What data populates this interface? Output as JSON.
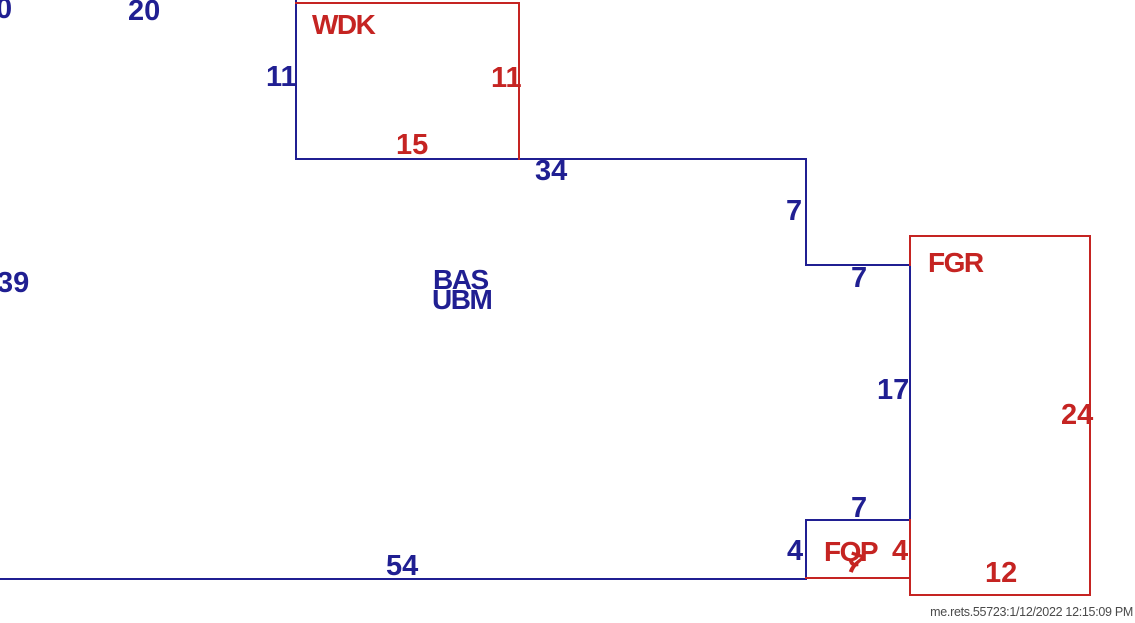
{
  "sketch": {
    "background": "#ffffff",
    "colors": {
      "blue": "#201f92",
      "red": "#c52422",
      "watermark": "#4a4a4a"
    },
    "watermark": "me.rets.55723:1/12/2022 12:15:09 PM",
    "area_codes": [
      "WDK",
      "BAS",
      "UBM",
      "FGR",
      "FQP"
    ],
    "labels": [
      {
        "name": "dim-top-left-0",
        "kind": "dimension",
        "text": "0",
        "color": "blue",
        "x": -4,
        "y": -6
      },
      {
        "name": "dim-top-20",
        "kind": "dimension",
        "text": "20",
        "color": "blue",
        "x": 128,
        "y": -4
      },
      {
        "name": "area-label-wdk",
        "kind": "area",
        "text": "WDK",
        "color": "red",
        "x": 312,
        "y": 10
      },
      {
        "name": "dim-wdk-left-11",
        "kind": "dimension",
        "text": "11",
        "color": "blue",
        "x": 266,
        "y": 62
      },
      {
        "name": "dim-wdk-right-11",
        "kind": "dimension",
        "text": "11",
        "color": "red",
        "x": 491,
        "y": 63
      },
      {
        "name": "dim-wdk-bottom-15",
        "kind": "dimension",
        "text": "15",
        "color": "red",
        "x": 396,
        "y": 130
      },
      {
        "name": "dim-main-top-34",
        "kind": "dimension",
        "text": "34",
        "color": "blue",
        "x": 535,
        "y": 156
      },
      {
        "name": "dim-step-down-7",
        "kind": "dimension",
        "text": "7",
        "color": "blue",
        "x": 786,
        "y": 196
      },
      {
        "name": "dim-step-right-7",
        "kind": "dimension",
        "text": "7",
        "color": "blue",
        "x": 851,
        "y": 263
      },
      {
        "name": "area-label-fgr",
        "kind": "area",
        "text": "FGR",
        "color": "red",
        "x": 928,
        "y": 248
      },
      {
        "name": "dim-left-39",
        "kind": "dimension",
        "text": "39",
        "color": "blue",
        "x": -3,
        "y": 268
      },
      {
        "name": "area-label-bas",
        "kind": "area",
        "text": "BAS",
        "color": "blue",
        "x": 433,
        "y": 265
      },
      {
        "name": "area-label-ubm",
        "kind": "area",
        "text": "UBM",
        "color": "blue",
        "x": 432,
        "y": 285
      },
      {
        "name": "dim-fgr-left-17",
        "kind": "dimension",
        "text": "17",
        "color": "blue",
        "x": 877,
        "y": 375
      },
      {
        "name": "dim-fgr-right-24",
        "kind": "dimension",
        "text": "24",
        "color": "red",
        "x": 1061,
        "y": 400
      },
      {
        "name": "dim-fqp-top-7",
        "kind": "dimension",
        "text": "7",
        "color": "blue",
        "x": 851,
        "y": 493
      },
      {
        "name": "dim-fqp-left-4",
        "kind": "dimension",
        "text": "4",
        "color": "blue",
        "x": 787,
        "y": 536
      },
      {
        "name": "area-label-fqp",
        "kind": "area",
        "text": "FQP",
        "color": "red",
        "x": 824,
        "y": 537
      },
      {
        "name": "dim-fqp-right-4",
        "kind": "dimension",
        "text": "4",
        "color": "red",
        "x": 892,
        "y": 536
      },
      {
        "name": "dim-fqp-bottom-7",
        "kind": "dimension",
        "text": "7",
        "color": "red",
        "x": 847,
        "y": 549,
        "rotate": 18
      },
      {
        "name": "dim-fgr-bottom-12",
        "kind": "dimension",
        "text": "12",
        "color": "red",
        "x": 985,
        "y": 558
      },
      {
        "name": "dim-main-bottom-54",
        "kind": "dimension",
        "text": "54",
        "color": "blue",
        "x": 386,
        "y": 551
      }
    ],
    "lines": [
      {
        "name": "wdk-left-wall",
        "color": "blue",
        "x": 295,
        "y": 0,
        "w": 2,
        "h": 160
      },
      {
        "name": "wdk-bottom-wall",
        "color": "blue",
        "x": 295,
        "y": 158,
        "w": 512,
        "h": 2
      },
      {
        "name": "step-down-wall",
        "color": "blue",
        "x": 805,
        "y": 158,
        "w": 2,
        "h": 108
      },
      {
        "name": "step-right-wall",
        "color": "blue",
        "x": 805,
        "y": 264,
        "w": 106,
        "h": 2
      },
      {
        "name": "fgr-left-upper-wall",
        "color": "blue",
        "x": 909,
        "y": 264,
        "w": 2,
        "h": 257
      },
      {
        "name": "fqp-top-wall",
        "color": "blue",
        "x": 805,
        "y": 519,
        "w": 106,
        "h": 2
      },
      {
        "name": "fqp-left-wall",
        "color": "blue",
        "x": 805,
        "y": 519,
        "w": 2,
        "h": 61
      },
      {
        "name": "main-bottom-wall",
        "color": "blue",
        "x": 0,
        "y": 578,
        "w": 807,
        "h": 2
      },
      {
        "name": "wdk-top-wall",
        "color": "red",
        "x": 295,
        "y": 2,
        "w": 225,
        "h": 2
      },
      {
        "name": "wdk-right-wall",
        "color": "red",
        "x": 518,
        "y": 2,
        "w": 2,
        "h": 158
      },
      {
        "name": "fgr-top-wall",
        "color": "red",
        "x": 909,
        "y": 235,
        "w": 182,
        "h": 2
      },
      {
        "name": "fgr-left-top-wall",
        "color": "red",
        "x": 909,
        "y": 235,
        "w": 2,
        "h": 31
      },
      {
        "name": "fgr-right-wall",
        "color": "red",
        "x": 1089,
        "y": 235,
        "w": 2,
        "h": 361
      },
      {
        "name": "fgr-bottom-wall",
        "color": "red",
        "x": 909,
        "y": 594,
        "w": 182,
        "h": 2
      },
      {
        "name": "fgr-left-lower-wall",
        "color": "red",
        "x": 909,
        "y": 519,
        "w": 2,
        "h": 77
      },
      {
        "name": "fqp-bottom-wall",
        "color": "red",
        "x": 805,
        "y": 577,
        "w": 106,
        "h": 2
      }
    ]
  }
}
